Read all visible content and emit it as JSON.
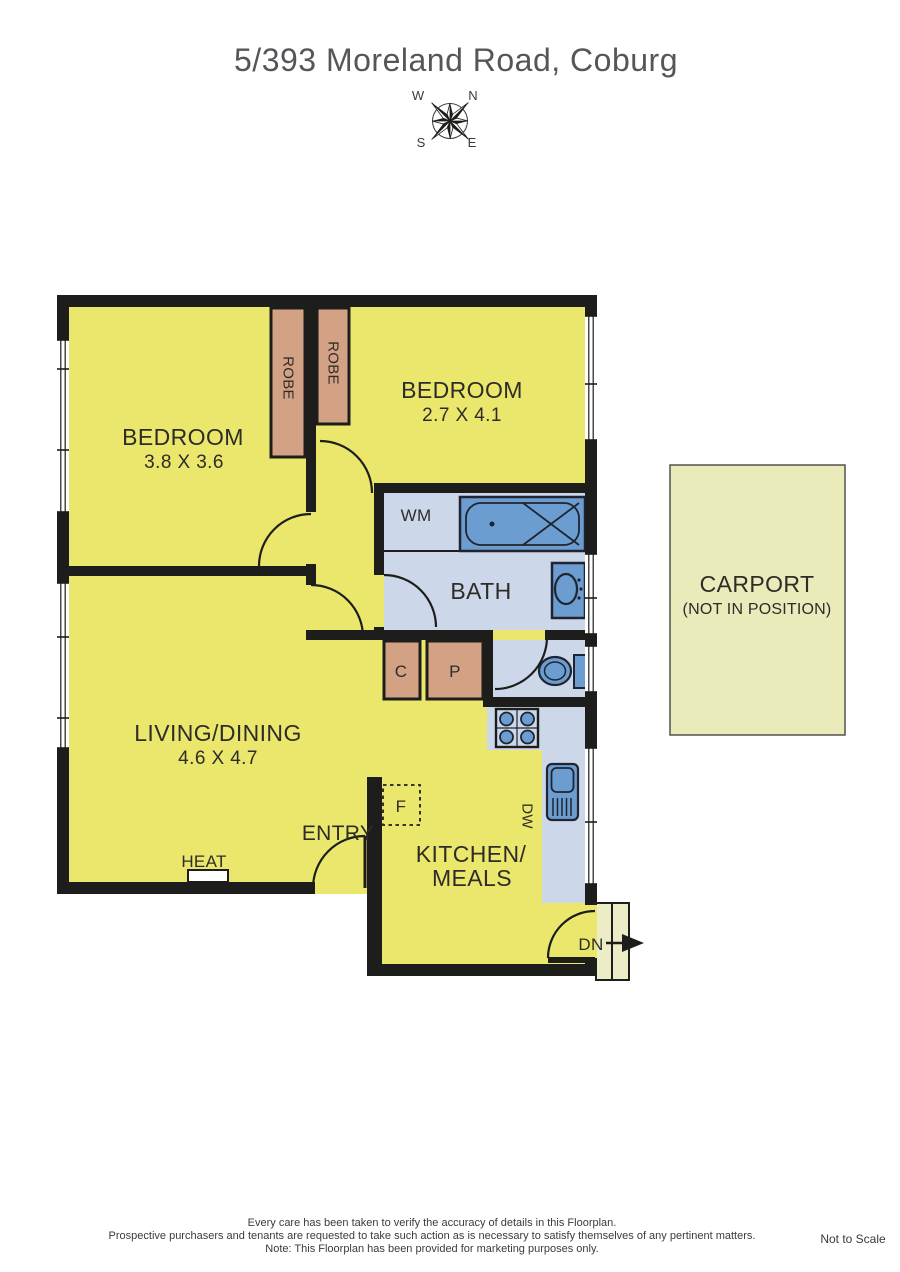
{
  "title": "5/393 Moreland Road, Coburg",
  "compass": {
    "n": "N",
    "s": "S",
    "e": "E",
    "w": "W"
  },
  "rooms": {
    "bedroom1": {
      "name": "BEDROOM",
      "dims": "3.8 X 3.6"
    },
    "bedroom2": {
      "name": "BEDROOM",
      "dims": "2.7 X 4.1"
    },
    "living": {
      "name": "LIVING/DINING",
      "dims": "4.6 X 4.7"
    },
    "kitchen": {
      "line1": "KITCHEN/",
      "line2": "MEALS"
    },
    "bath": {
      "name": "BATH"
    },
    "entry": {
      "name": "ENTRY"
    },
    "carport": {
      "name": "CARPORT",
      "note": "(NOT IN POSITION)"
    }
  },
  "labels": {
    "robe1": "ROBE",
    "robe2": "ROBE",
    "wm": "WM",
    "heat": "HEAT",
    "dn": "DN",
    "dw": "DW",
    "c": "C",
    "p": "P",
    "f": "F"
  },
  "footer": {
    "line1": "Every care has been taken to verify the accuracy of details in this Floorplan.",
    "line2": "Prospective purchasers and tenants are requested to take such action as is necessary to satisfy themselves of any pertinent matters.",
    "line3": "Note: This Floorplan has been provided for marketing purposes only.",
    "scale_note": "Not to Scale"
  },
  "colors": {
    "room_yellow": "#ebe76c",
    "wet_area_blue": "#ccd7e9",
    "fixture_blue": "#6b9dd1",
    "robe_tan": "#d3a284",
    "wall": "#1d1d1b",
    "carport_fill": "#e9ebbb",
    "stair_fill": "#ecedc6",
    "title_gray": "#55565a"
  }
}
